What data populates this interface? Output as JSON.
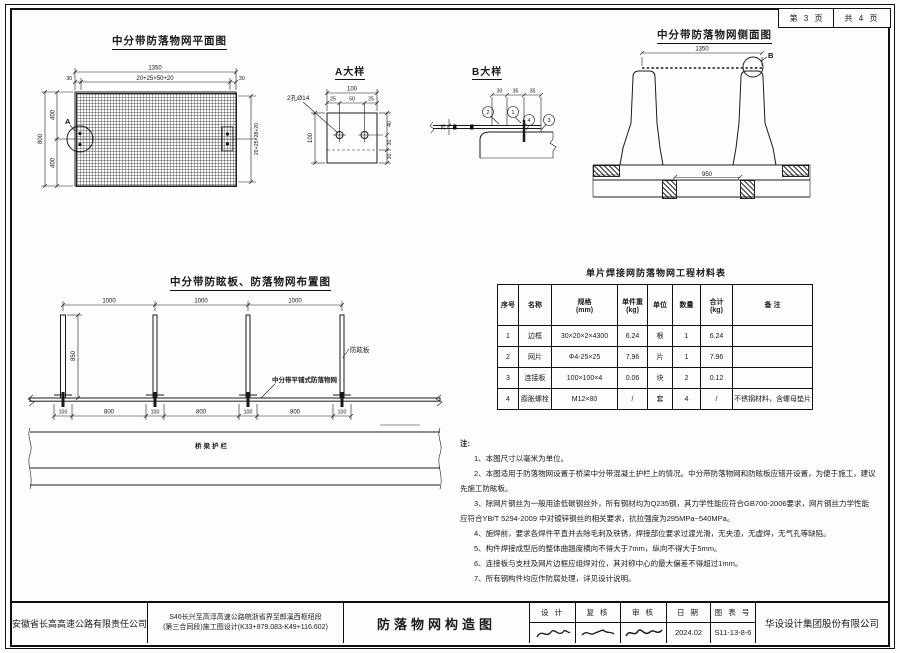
{
  "sheet": {
    "page_no": "第 3 页",
    "page_total": "共 4 页"
  },
  "plan_view": {
    "title": "中分带防落物网平面图",
    "detail_ref": "A",
    "dims": {
      "total_width": "1350",
      "edge_left": "30",
      "mesh_width": "20+25×50+20",
      "edge_right": "30",
      "total_height": "800",
      "half_top": "400",
      "half_bottom": "400",
      "mesh_height": "20+25×28+20"
    }
  },
  "detail_a": {
    "title": "A大样",
    "hole_label": "2孔Ø14",
    "dims": {
      "width": "100",
      "left": "25",
      "center": "50",
      "right": "25",
      "height": "100",
      "r_top": "40",
      "r_mid": "30",
      "r_bot": "30"
    }
  },
  "detail_b": {
    "title": "B大样",
    "dims": {
      "d1": "30",
      "d2": "35",
      "d3": "35",
      "side": "25"
    },
    "callouts": {
      "c1": "1",
      "c2": "2",
      "c3": "3",
      "c4": "4"
    }
  },
  "side_view": {
    "title": "中分带防落物网侧面图",
    "detail_ref": "B",
    "dims": {
      "net_width": "1350",
      "base_gap": "950"
    }
  },
  "layout_view": {
    "title": "中分带防眩板、防落物网布置图",
    "dims": {
      "spacing1": "1000",
      "spacing2": "1000",
      "spacing3": "1000",
      "post_height": "850",
      "net_length": "800",
      "anchor_gap": "100"
    },
    "labels": {
      "glare_board": "防眩板",
      "net": "中分带平铺式防落物网",
      "guardrail": "桥梁护栏"
    }
  },
  "material_table": {
    "title": "单片焊接网防落物网工程材料表",
    "headers": [
      "序号",
      "名称",
      "规格\n(mm)",
      "单件重\n(kg)",
      "单位",
      "数量",
      "合计\n(kg)",
      "备 注"
    ],
    "rows": [
      [
        "1",
        "边框",
        "30×20×2×4300",
        "6.24",
        "根",
        "1",
        "6.24",
        ""
      ],
      [
        "2",
        "网片",
        "Φ4-25×25",
        "7.96",
        "片",
        "1",
        "7.96",
        ""
      ],
      [
        "3",
        "连接板",
        "100×100×4",
        "0.06",
        "块",
        "2",
        "0.12",
        ""
      ],
      [
        "4",
        "膨胀螺栓",
        "M12×80",
        "/",
        "套",
        "4",
        "/",
        "不锈钢材料，含螺母垫片"
      ]
    ]
  },
  "notes": {
    "heading": "注:",
    "items": [
      "1、本图尺寸以毫米为单位。",
      "2、本图适用于防落物网设置于桥梁中分带混凝土护栏上的情况。中分带防落物网和防眩板应错开设置，为便于施工，建议先施工防眩板。",
      "3、除网片钢丝为一般用途低碳钢丝外，所有钢材均为Q235钢，其力学性能应符合GB700-2006要求，网片钢丝力学性能应符合YB/T 5294-2009 中对镀锌钢丝的相关要求，抗拉强度为295MPa~540MPa。",
      "4、施焊前，要求各焊件平直并去除毛刺及铁锈，焊接部位要求过渡光滑，无夹渣，无虚焊，无气孔等缺陷。",
      "5、构件焊接成型后的整体曲翘度横向不得大于7mm，纵向不得大于5mm。",
      "6、连接板与支柱及网片边框应组焊对位，其对称中心的最大偏差不得超过1mm。",
      "7、所有钢构件均应作防腐处理，详见设计说明。"
    ]
  },
  "title_block": {
    "company": "安徽省长高高速公路有限责任公司",
    "project_line1": "S46长兴至高淳高速公路皖浙省界至郎溪西枢纽段",
    "project_line2": "(第三合同段)施工图设计(K33+979.083-K49+116.602)",
    "drawing_title": "防落物网构造图",
    "design_label": "设 计",
    "check_label": "复 核",
    "review_label": "审 核",
    "date_label": "日 期",
    "sheet_label": "图 表 号",
    "date_value": "2024.02",
    "sheet_value": "S11-13-8-6",
    "design_company": "华设设计集团股份有限公司"
  }
}
